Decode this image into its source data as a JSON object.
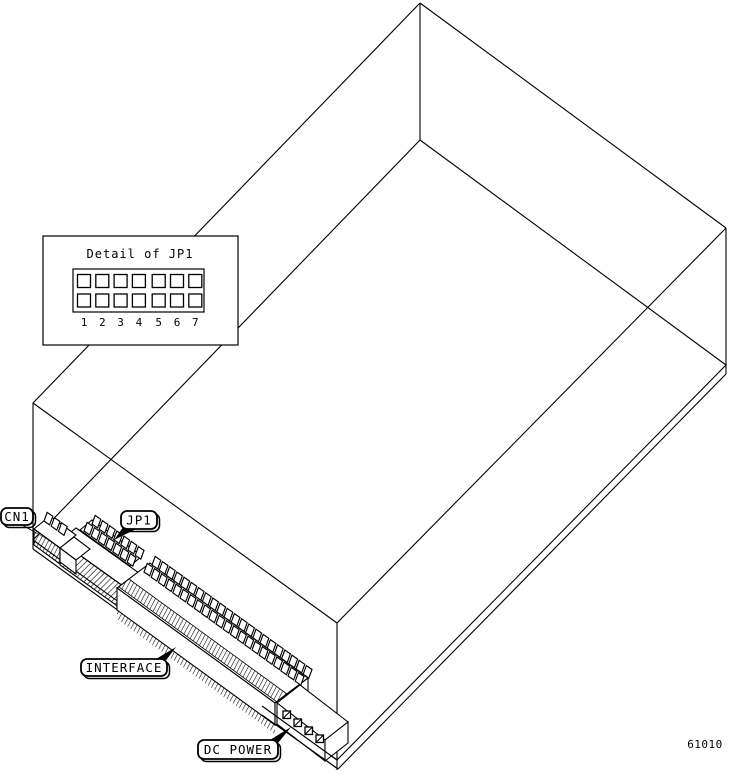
{
  "diagram": {
    "figure_number": "61010",
    "detail_inset": {
      "title": "Detail of JP1",
      "pins": [
        "1",
        "2",
        "3",
        "4",
        "5",
        "6",
        "7"
      ]
    },
    "callouts": {
      "cn1": "CN1",
      "jp1": "JP1",
      "interface": "INTERFACE",
      "dc_power": "DC POWER"
    },
    "colors": {
      "line": "#000000",
      "background": "#ffffff"
    }
  }
}
